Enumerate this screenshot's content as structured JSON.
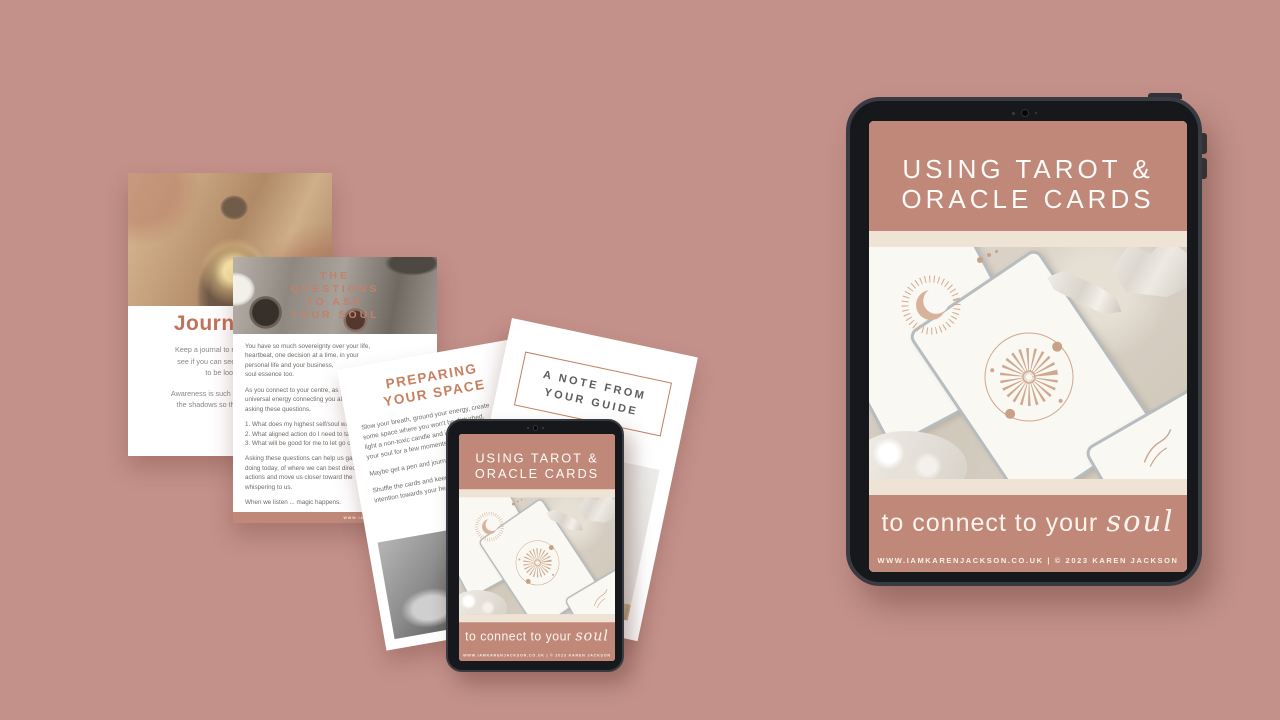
{
  "background": {
    "color": "#c39189"
  },
  "brand_colors": {
    "rose": "#bf8878",
    "cream": "#eee3d4",
    "terracotta": "#c5826a",
    "heading_rust": "#c0725a",
    "bezel_dark": "#17181c"
  },
  "cover": {
    "title_line1": "USING TAROT &",
    "title_line2": "ORACLE CARDS",
    "tagline": "to connect to your",
    "tagline_script": "soul",
    "footer": "WWW.IAMKARENJACKSON.CO.UK | © 2023 KAREN JACKSON"
  },
  "page_journaling": {
    "heading": "Journaling",
    "para1": [
      "Keep a journal to reflect upon your",
      "see if you can see some patterns",
      "to be looked at."
    ],
    "para2": [
      "Awareness is such a healing practice",
      "the shadows so that you can see."
    ]
  },
  "page_questions": {
    "title_lines": [
      "THE",
      "QUESTIONS",
      "TO ASK",
      "YOUR SOUL"
    ],
    "para1": [
      "You have so much sovereignty over your life,",
      "heartbeat, one decision at a time, in your",
      "personal life and your business,",
      "soul essence too."
    ],
    "para2": [
      "As you connect to your centre, as the",
      "universal energy connecting you all, try",
      "asking these questions."
    ],
    "list": [
      "1. What does my highest self/soul want?",
      "2. What aligned action do I need to take?",
      "3. What will be good for me to let go of?"
    ],
    "para3": [
      "Asking these questions can help us gain a",
      "doing today, of where we can best direct our",
      "actions and move us closer toward the",
      "whispering to us."
    ],
    "para4": "When we listen ... magic happens.",
    "footer": "WWW.IAMKARENJACKSON.CO.UK"
  },
  "page_preparing": {
    "title_line1": "PREPARING",
    "title_line2": "YOUR SPACE",
    "para1": [
      "Slow your breath, ground your energy, create",
      "some space where you won't be disturbed,",
      "light a non-toxic candle and intend to be",
      "your soul for a few moments."
    ],
    "para2": "Maybe get a pen and journal too.",
    "para3": [
      "Shuffle the cards and keep your",
      "intention towards your heart."
    ]
  },
  "page_note": {
    "box_line1": "A NOTE FROM",
    "box_line2": "YOUR GUIDE",
    "footer": "WWW.IAMKARENJACKSON.CO.UK | © 2023 KAREN JACKSON"
  }
}
